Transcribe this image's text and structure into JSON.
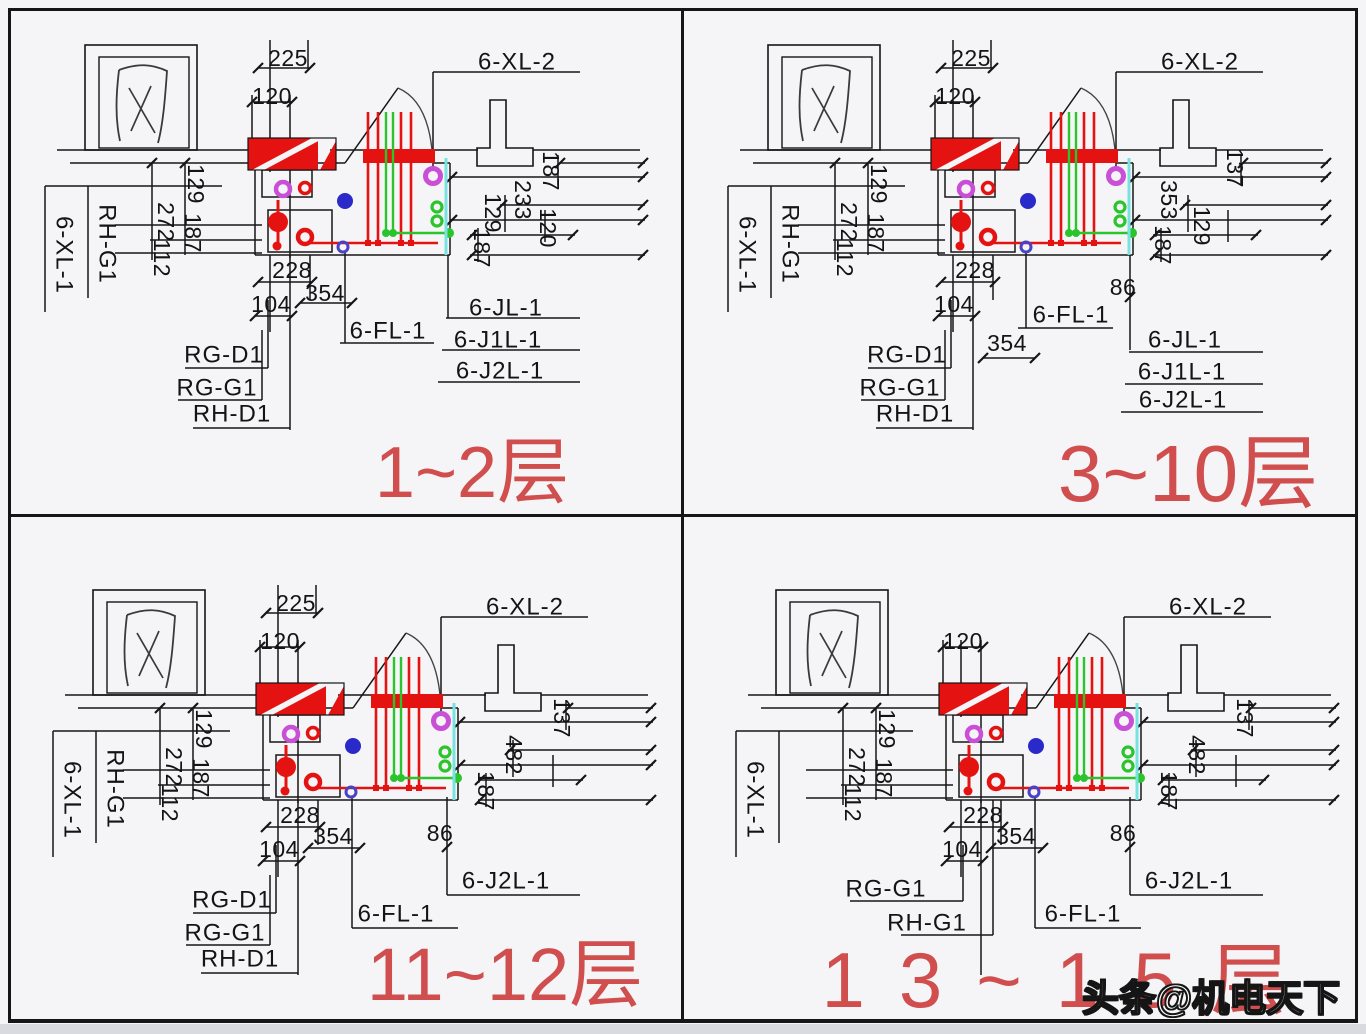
{
  "watermark": "头条@机电天下",
  "colors": {
    "line": "#161616",
    "pipe_red": "#e51212",
    "pipe_green": "#2cc42c",
    "magenta": "#c94fd6",
    "blue_dot": "#2a2acb",
    "purple_ring": "#4a42c4",
    "cyan": "#78e2e2",
    "floor_red": "#d04e4e",
    "background": "#f5f5f7"
  },
  "quadrants": [
    {
      "floor_label": "1~2层",
      "window_char": "风",
      "top_pipe_label": "6-XL-2",
      "left_pipe_labels": [
        "6-XL-1",
        "RH-G1"
      ],
      "dims_top": [
        "225",
        "120"
      ],
      "dims_left": [
        "129",
        "272",
        "187",
        "112"
      ],
      "dims_right": [
        "187",
        "233",
        "129",
        "120",
        "187"
      ],
      "dims_bottom": [
        "228",
        "354",
        "104"
      ],
      "branch_dim": "",
      "bottom_left_labels": [
        "RG-D1",
        "RG-G1",
        "RH-D1"
      ],
      "floor_drain_label": "6-FL-1",
      "riser_labels": [
        "6-JL-1",
        "6-J1L-1",
        "6-J2L-1"
      ]
    },
    {
      "floor_label": "3~10层",
      "window_char": "风",
      "top_pipe_label": "6-XL-2",
      "left_pipe_labels": [
        "6-XL-1",
        "RH-G1"
      ],
      "dims_top": [
        "225",
        "120"
      ],
      "dims_left": [
        "129",
        "272",
        "187",
        "112"
      ],
      "dims_right": [
        "137",
        "353",
        "129",
        "187"
      ],
      "dims_bottom": [
        "228",
        "354",
        "104"
      ],
      "branch_dim": "86",
      "bottom_left_labels": [
        "RG-D1",
        "RG-G1",
        "RH-D1"
      ],
      "floor_drain_label": "6-FL-1",
      "riser_labels": [
        "6-JL-1",
        "6-J1L-1",
        "6-J2L-1"
      ]
    },
    {
      "floor_label": "11~12层",
      "window_char": "风",
      "top_pipe_label": "6-XL-2",
      "left_pipe_labels": [
        "6-XL-1",
        "RH-G1"
      ],
      "dims_top": [
        "225",
        "120"
      ],
      "dims_left": [
        "129",
        "272",
        "187",
        "112"
      ],
      "dims_right": [
        "137",
        "482",
        "187"
      ],
      "dims_bottom": [
        "228",
        "354",
        "104"
      ],
      "branch_dim": "86",
      "bottom_left_labels": [
        "RG-D1",
        "RG-G1",
        "RH-D1"
      ],
      "floor_drain_label": "6-FL-1",
      "riser_labels": [
        "6-J2L-1"
      ]
    },
    {
      "floor_label": "13~15层",
      "window_char": "风",
      "top_pipe_label": "6-XL-2",
      "left_pipe_labels": [
        "6-XL-1"
      ],
      "dims_top": [
        "120"
      ],
      "dims_left": [
        "129",
        "272",
        "187",
        "112"
      ],
      "dims_right": [
        "137",
        "482",
        "187"
      ],
      "dims_bottom": [
        "228",
        "354",
        "104"
      ],
      "branch_dim": "86",
      "bottom_left_labels": [
        "RG-G1",
        "RH-G1"
      ],
      "floor_drain_label": "6-FL-1",
      "riser_labels": [
        "6-J2L-1"
      ]
    }
  ]
}
